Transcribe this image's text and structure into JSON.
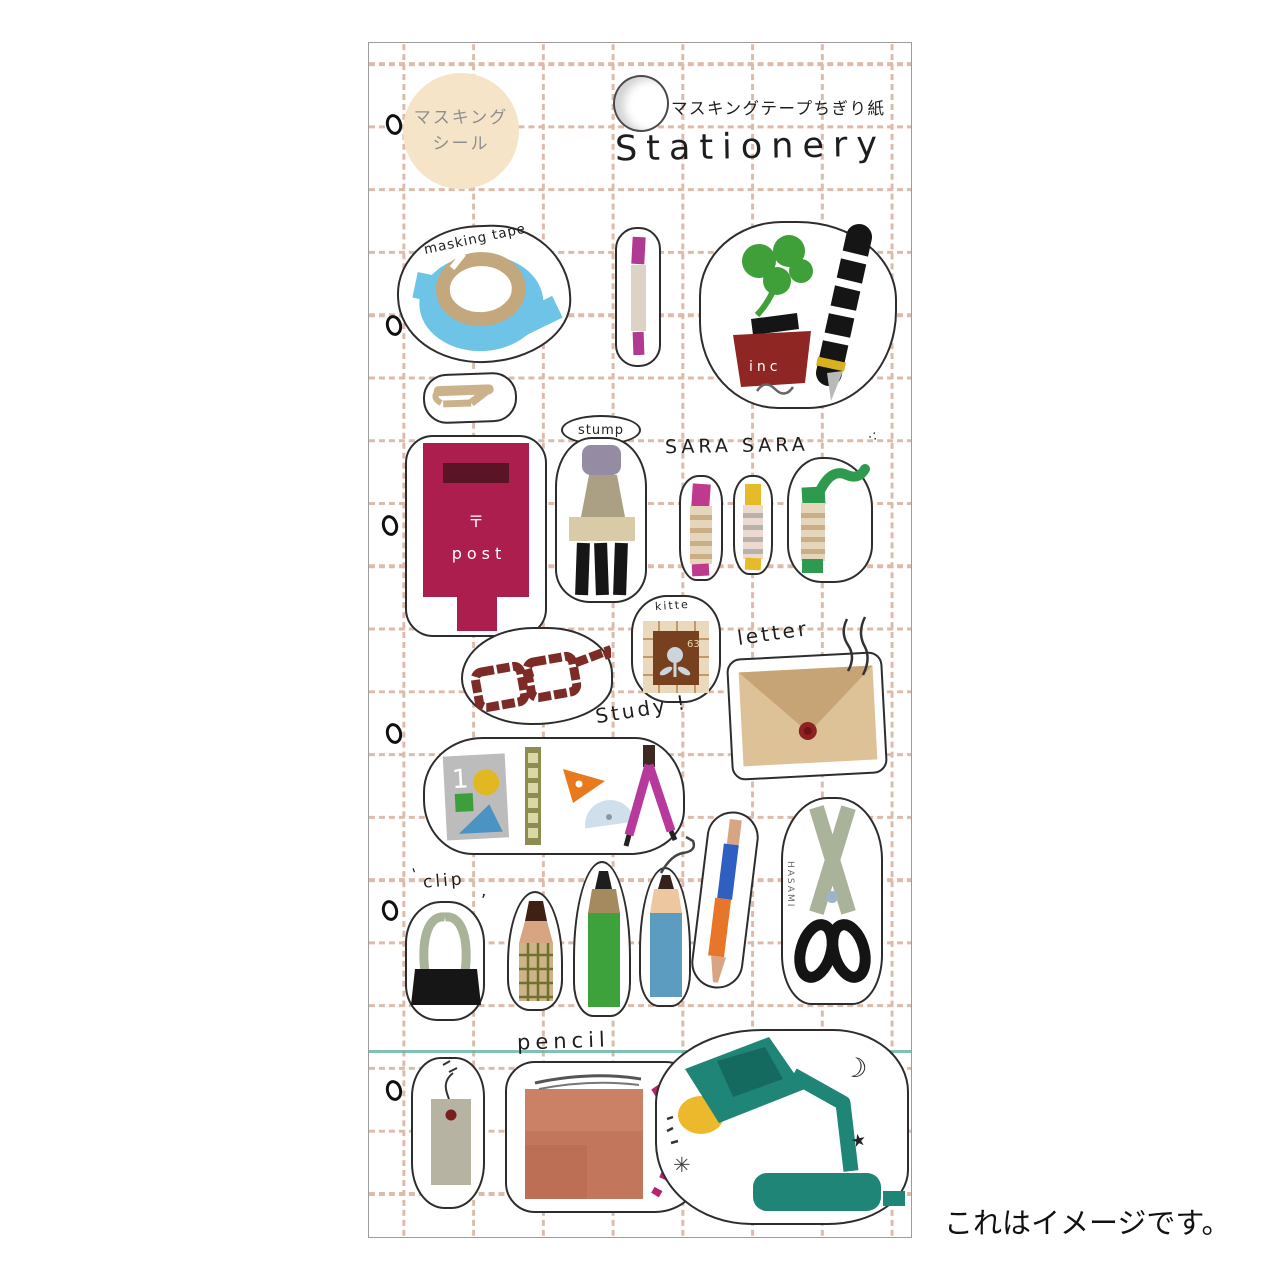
{
  "caption": "これはイメージです。",
  "badge": {
    "line1": "マスキング",
    "line2": "シール"
  },
  "header": {
    "subtitle": "マスキングテープちぎり紙",
    "title": "Stationery"
  },
  "labels": {
    "masking_tape": "masking tape",
    "stump": "stump",
    "sara": "SARA SARA",
    "kitte": "kitte",
    "letter": "letter",
    "study": "Study !",
    "clip": "clip",
    "pencil": "pencil",
    "hasami": "HASAMI",
    "inc": "inc",
    "post_mark": "〒",
    "post": "post",
    "book_number": "1",
    "stamp_number": "63"
  },
  "doodles": {
    "moon": "☽",
    "star": "★",
    "sparkle": "✳",
    "tick": "'",
    "comma": ",",
    "dots": "∴"
  },
  "stickers": [
    "masking-tape",
    "marker-pen",
    "ink-and-quill",
    "hairpin",
    "stamp",
    "post-box",
    "crayon-magenta",
    "crayon-yellow",
    "crayon-green",
    "glasses",
    "kitte-stamp",
    "envelope",
    "study-set",
    "binder-clip",
    "pencil-plaid",
    "pencil-green",
    "pencil-blue",
    "ballpoint-pen",
    "scissors",
    "tag",
    "notebook",
    "desk-lamp"
  ],
  "colors": {
    "grid_line": "#c08565",
    "teal_rule": "#62b3a4",
    "badge_bg": "#f6e4c8",
    "tape_blue": "#6ec4e6",
    "tape_core_tan": "#c3a77d",
    "clover_green": "#3fa03a",
    "ink_red": "#8e2723",
    "post_red": "#ac1e4e",
    "crayon_magenta": "#bf3a8d",
    "crayon_yellow": "#e5bb2a",
    "crayon_green": "#2e9a4e",
    "glasses_maroon": "#7d2b26",
    "envelope_tan": "#ddc197",
    "wax_seal": "#8e2222",
    "ruler_olive": "#8d8d52",
    "triangle_orange": "#e8791d",
    "protractor_blue": "#cfe0ec",
    "compass_magenta": "#b6399b",
    "scissor_sage": "#a9b39a",
    "pencil_green": "#3da23c",
    "pencil_blue": "#5b9cc0",
    "pen_blue": "#2f5fc0",
    "pen_orange": "#e8762a",
    "notebook_salmon": "#c2765c",
    "dash_magenta": "#b5256e",
    "lamp_teal": "#1f8577",
    "lamp_yellow": "#ecb92c"
  }
}
